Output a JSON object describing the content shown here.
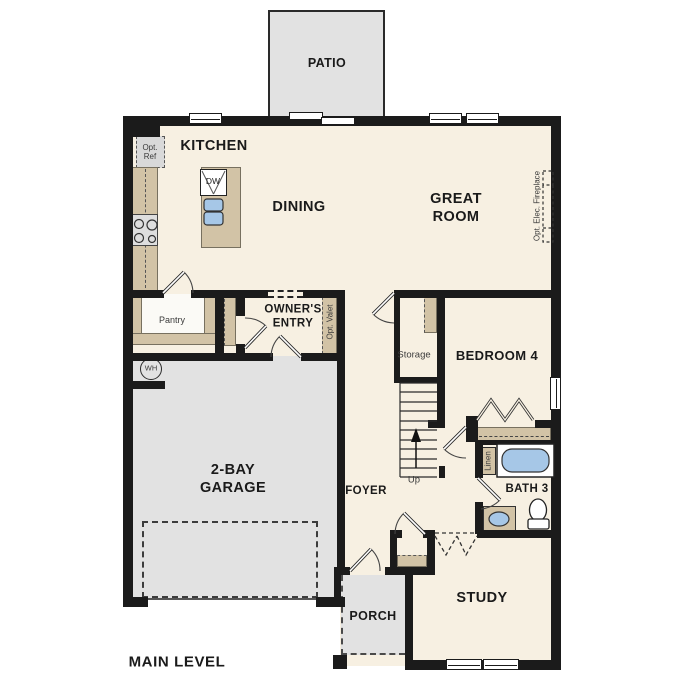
{
  "plan": {
    "title": "MAIN LEVEL",
    "rooms": {
      "patio": "PATIO",
      "kitchen": "KITCHEN",
      "dining": "DINING",
      "great_room": "GREAT\nROOM",
      "owners_entry": "OWNER'S\nENTRY",
      "garage": "2-BAY\nGARAGE",
      "foyer": "FOYER",
      "bedroom4": "BEDROOM 4",
      "bath3": "BATH 3",
      "study": "STUDY",
      "porch": "PORCH"
    },
    "annotations": {
      "opt_ref": "Opt.\nRef",
      "dishwasher": "DW",
      "pantry": "Pantry",
      "opt_valet": "Opt. Valet",
      "opt_elec_fireplace": "Opt. Elec. Fireplace",
      "water_heater": "WH",
      "storage": "Storage",
      "stairs_up": "Up",
      "linen": "Linen"
    },
    "colors": {
      "floor": "#f7f0e2",
      "hard_surface": "#e2e2e2",
      "wall": "#1b1b1b",
      "cabinet": "#d2c3a6",
      "fixture_blue": "#a6c7e7"
    }
  }
}
